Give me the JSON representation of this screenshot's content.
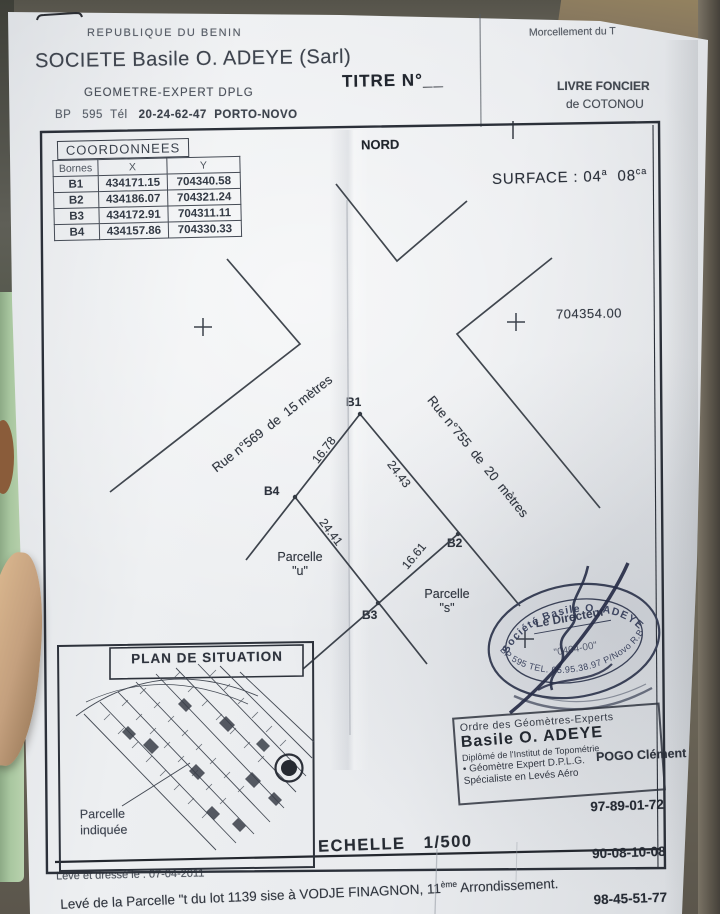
{
  "header": {
    "republic": "REPUBLIQUE DU BENIN",
    "company": "SOCIETE Basile O. ADEYE (Sarl)",
    "profession": "GEOMETRE-EXPERT DPLG",
    "bp_left": "BP   595  Tél   ",
    "bp_right": "20-24-62-47  PORTO-NOVO",
    "titre": "TITRE N°__",
    "morcellement": "Morcellement du T",
    "livre1": "LIVRE FONCIER",
    "livre2": "de COTONOU"
  },
  "table": {
    "title": "COORDONNEES",
    "col_bornes": "Bornes",
    "col_x": "X",
    "col_y": "Y",
    "rows": [
      [
        "B1",
        "434171.15",
        "704340.58"
      ],
      [
        "B2",
        "434186.07",
        "704321.24"
      ],
      [
        "B3",
        "434172.91",
        "704311.11"
      ],
      [
        "B4",
        "434157.86",
        "704330.33"
      ]
    ]
  },
  "plan": {
    "nord": "NORD",
    "surface_prefix": "SURFACE : 04",
    "sup_a": "a",
    "surface_mid": "  08",
    "sup_ca": "ca",
    "grid_label": "704354.00",
    "rue569": "Rue n°569  de  15 mètres",
    "rue755": "Rue n°755  de  20  mètres",
    "bornes": [
      "B1",
      "B2",
      "B3",
      "B4"
    ],
    "d_b4b1": "16.78",
    "d_b1b2": "24.43",
    "d_b4b3": "24.41",
    "d_b3b2": "16.61",
    "parcelle_u1": "Parcelle",
    "parcelle_u2": "\"u\"",
    "parcelle_s1": "Parcelle",
    "parcelle_s2": "\"s\""
  },
  "inset": {
    "title": "PLAN DE SITUATION",
    "cap1": "Parcelle",
    "cap2": "indiquée"
  },
  "scale": {
    "label": "ECHELLE   1/500"
  },
  "footer": {
    "date": "Levé et dressé le : 07-04-2011",
    "desc": "Levé de la Parcelle \"t du lot 1139 sise à VODJE FINAGNON, 11",
    "desc_sup": "ème",
    "desc_tail": " Arrondissement."
  },
  "oval": {
    "top": "Société Basile O. ADEYE",
    "bottom": "BP 595 TEL. 05.95.38.97 P/Novo R.B",
    "director": "Le Directeur",
    "number": "\"0404-00\""
  },
  "rstamp": {
    "l1": "Ordre des Géomètres-Experts",
    "l2": "Basile O. ADEYE",
    "l3": "Diplômé de l'Institut de Topométrie",
    "l4": "•  Géomètre Expert D.P.L.G.",
    "l5": "Spécialiste en Levés Aéro",
    "name": "POGO Clément",
    "numbers": [
      "97-89-01-72",
      "90-08-10-08",
      "98-45-51-77"
    ]
  }
}
